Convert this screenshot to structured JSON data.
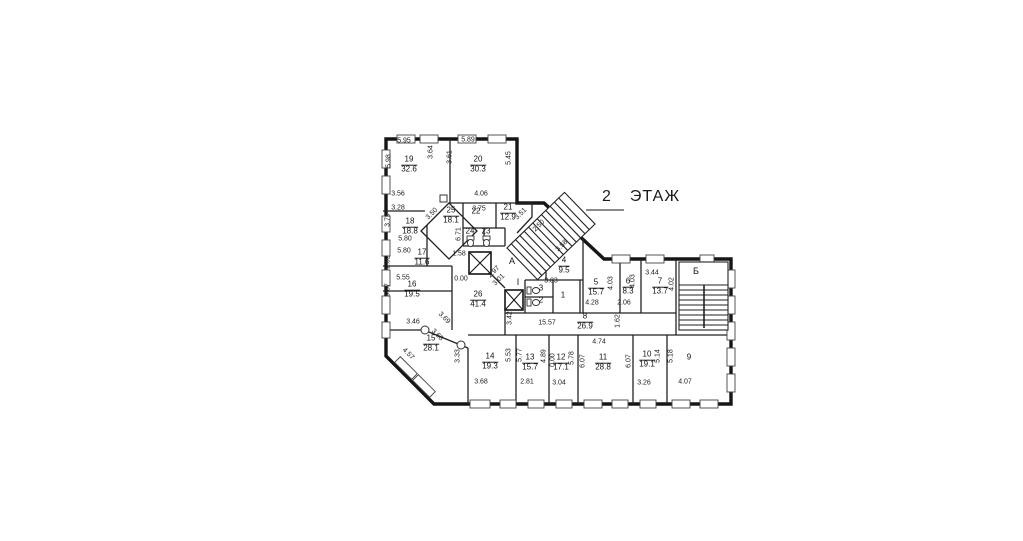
{
  "title": {
    "floor_number": "2",
    "floor_word": "ЭТАЖ"
  },
  "zones": {
    "lobby_a": "A",
    "corridor_i": "I",
    "stair_b": "Б"
  },
  "rooms": {
    "r19": {
      "number": "19",
      "area": "32.6"
    },
    "r20": {
      "number": "20",
      "area": "30.3"
    },
    "r25": {
      "number": "25",
      "area": "18.1"
    },
    "r22": {
      "number": "22"
    },
    "r21": {
      "number": "21",
      "area": "12.9"
    },
    "r24": {
      "number": "24"
    },
    "r23": {
      "number": "23"
    },
    "r18": {
      "number": "18",
      "area": "18.8"
    },
    "r17": {
      "number": "17",
      "area": "11.6"
    },
    "r16": {
      "number": "16",
      "area": "19.5"
    },
    "r15": {
      "number": "15",
      "area": "28.1"
    },
    "r26": {
      "number": "26",
      "area": "41.4"
    },
    "r14": {
      "number": "14",
      "area": "19.3"
    },
    "r13": {
      "number": "13",
      "area": "15.7"
    },
    "r12": {
      "number": "12",
      "area": "17.1"
    },
    "r11": {
      "number": "11",
      "area": "28.8"
    },
    "r10": {
      "number": "10",
      "area": "19.1"
    },
    "r9": {
      "number": "9"
    },
    "r8": {
      "number": "8",
      "area": "26.9"
    },
    "r7": {
      "number": "7",
      "area": "13.7"
    },
    "r6": {
      "number": "6",
      "area": "8.3"
    },
    "r5": {
      "number": "5",
      "area": "15.7"
    },
    "r4": {
      "number": "4",
      "area": "9.5"
    },
    "r3": {
      "number": "3"
    },
    "r2": {
      "number": "2"
    },
    "r1": {
      "number": "1"
    }
  },
  "dims": {
    "d01": "5.95",
    "d02": "5.89",
    "d03": "5.98",
    "d04": "3.64",
    "d05": "3.61",
    "d06": "5.45",
    "d07": "3.56",
    "d08": "3.50",
    "d09": "4.06",
    "d10": "3.75",
    "d11": "3.28",
    "d12": "3.79",
    "d13": "3.51",
    "d14": "2.50",
    "d15": "3.58",
    "d16": "6.71",
    "d17": "5.80",
    "d18": "5.80",
    "d19": "2.02",
    "d20": "1.58",
    "d21": "0.00",
    "d22": "2.97",
    "d23": "3.01",
    "d24": "5.55",
    "d25": "3.67",
    "d26": "3.83",
    "d27": "3.42",
    "d28": "3.44",
    "d29": "4.03",
    "d30": "4.03",
    "d31": "4.02",
    "d32": "4.28",
    "d33": "2.06",
    "d34": "3.46",
    "d35": "3.69",
    "d36": "3.68",
    "d37": "4.57",
    "d38": "3.33",
    "d39": "15.57",
    "d40": "1.62",
    "d41": "4.74",
    "d42": "5.53",
    "d43": "3.68",
    "d44": "5.77",
    "d45": "4.89",
    "d46": "2.81",
    "d47": "0.00",
    "d48": "5.78",
    "d49": "3.04",
    "d50": "6.07",
    "d51": "6.07",
    "d52": "5.14",
    "d53": "5.18",
    "d54": "3.26",
    "d55": "4.07"
  }
}
